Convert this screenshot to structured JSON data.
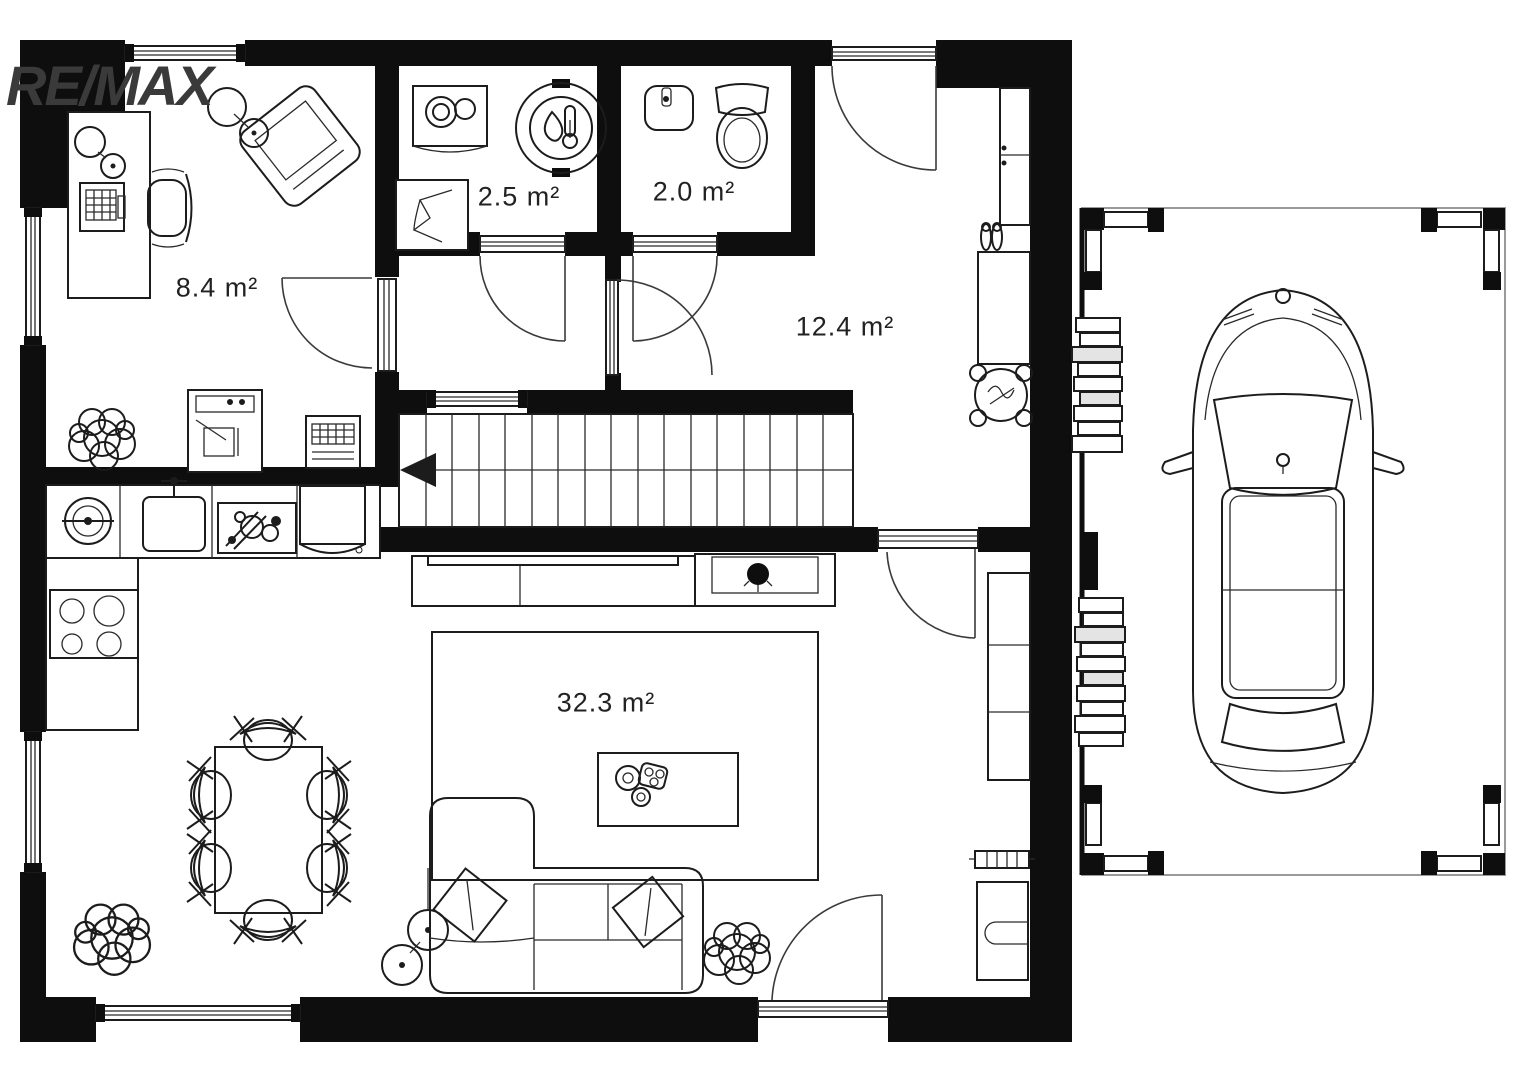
{
  "brand": {
    "logo_text": "RE/MAX",
    "logo_color": "#3a3a3a"
  },
  "rooms": [
    {
      "name": "office",
      "area_label": "8.4 m²"
    },
    {
      "name": "utility-room",
      "area_label": "2.5 m²"
    },
    {
      "name": "wc",
      "area_label": "2.0 m²"
    },
    {
      "name": "hallway",
      "area_label": "12.4 m²"
    },
    {
      "name": "living-room-kitchen",
      "area_label": "32.3 m²"
    }
  ],
  "colors": {
    "walls": "#0e0e0e",
    "lines": "#1c1c1c",
    "background": "#ffffff"
  },
  "plan_elements": {
    "doors": [
      "entrance-door",
      "office-door",
      "utility-door",
      "wc-door",
      "corridor-door",
      "living-room-door",
      "terrace-door"
    ],
    "windows": [
      "office-top-window",
      "office-left-window",
      "living-left-window",
      "living-bottom-window",
      "stair-window"
    ],
    "icons": [
      "desk",
      "computer",
      "desk-lamp",
      "office-chair",
      "armchair",
      "floor-lamp",
      "potted-plant",
      "printer",
      "storage-box",
      "washing-machine",
      "water-heater",
      "laundry-basket",
      "hand-basin",
      "toilet",
      "wardrobe",
      "shoes",
      "dresser",
      "flower-stool",
      "staircase",
      "kitchen-counter",
      "round-sink",
      "kitchen-sink",
      "dish-rack",
      "fridge",
      "cooktop",
      "tv-lowboard",
      "tv",
      "plant-cabinet",
      "bookshelf",
      "radiator",
      "cabinet",
      "rug",
      "coffee-table",
      "sofa",
      "pillow",
      "dining-table",
      "dining-chair",
      "car",
      "carport",
      "firewood-stack"
    ]
  }
}
